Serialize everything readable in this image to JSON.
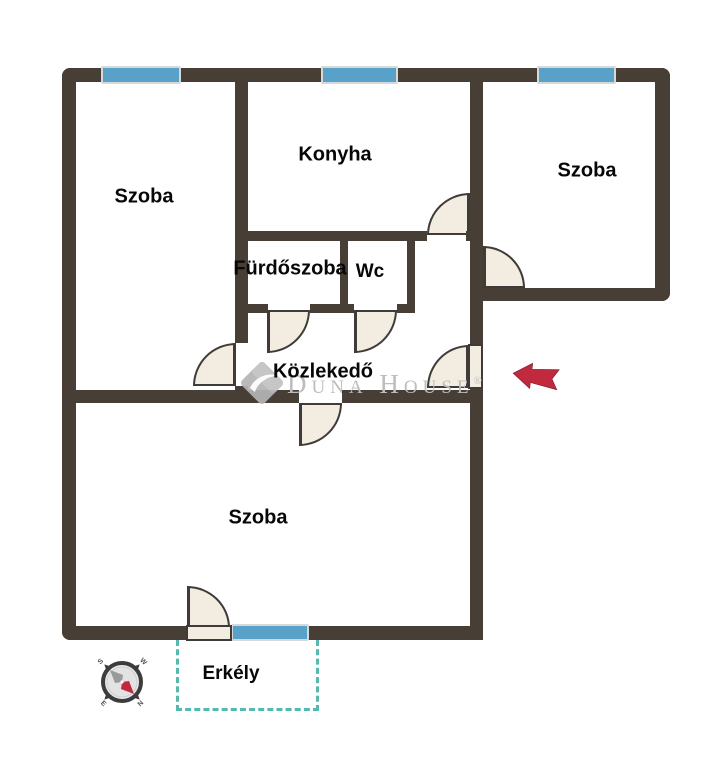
{
  "colors": {
    "wall": "#473E36",
    "window-blue": "#58A1C8",
    "window-edge": "#D8D8D8",
    "door-fill": "#F3ECE1",
    "door-line": "#3E3B38",
    "teal": "#56B8B0",
    "arrow-red": "#C12A3E",
    "watermark": "#BDBDBD",
    "logo-gray": "#B5B5B5"
  },
  "rooms": {
    "szoba_left": {
      "label": "Szoba"
    },
    "konyha": {
      "label": "Konyha"
    },
    "szoba_right": {
      "label": "Szoba"
    },
    "furdoszoba": {
      "label": "Fürdőszoba"
    },
    "wc": {
      "label": "Wc"
    },
    "kozlekedo": {
      "label": "Közlekedő"
    },
    "szoba_bottom": {
      "label": "Szoba"
    },
    "erkely": {
      "label": "Erkély"
    }
  },
  "watermark": {
    "brand": "Duna House",
    "registered": "®"
  },
  "compass": {
    "north": "N",
    "south": "S",
    "east": "E",
    "west": "W"
  }
}
